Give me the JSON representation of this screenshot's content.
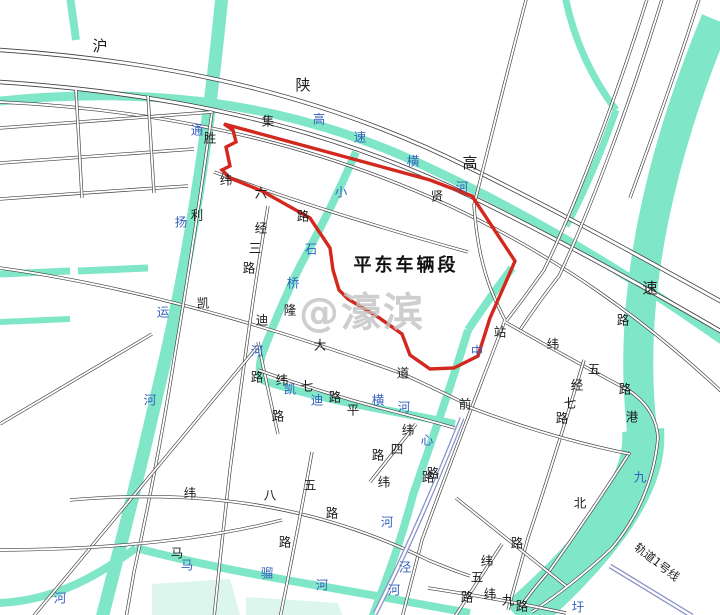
{
  "title": {
    "site_label": "平东车辆段"
  },
  "legend": {
    "rail_line_label": "轨道1号线"
  },
  "watermark": {
    "text": "@濠滨"
  },
  "palette": {
    "river": "#7fe7c8",
    "pond": "#dcf6ee",
    "road_casing": "#3f3f3f",
    "road_fill": "#ffffff",
    "boundary_red": "#d2281e",
    "label_black": "#1c1c1c",
    "label_blue": "#3560c0",
    "metro": "#8a92c8",
    "watermark_gray": "#c2c2c2"
  },
  "map": {
    "width": 720,
    "height": 615,
    "ponds": [
      {
        "id": "pond-west",
        "points": "152,584 230,579 240,615 152,615"
      },
      {
        "id": "pond-east",
        "points": "246,597 338,603 342,615 246,615"
      }
    ],
    "rivers": [
      {
        "id": "tongyang-canal",
        "w": 13,
        "d": "M222,-5 C210,120 192,250 158,390 C140,470 122,540 102,618"
      },
      {
        "id": "nw-stub",
        "w": 8,
        "d": "M70,-4 L76,40"
      },
      {
        "id": "strip-a",
        "w": 7,
        "d": "M0,274 L70,271"
      },
      {
        "id": "strip-b",
        "w": 7,
        "d": "M78,271 L148,268"
      },
      {
        "id": "strip-c",
        "w": 6,
        "d": "M0,322 L70,319"
      },
      {
        "id": "gaosu-henghe",
        "w": 9,
        "d": "M0,101 C150,86 290,102 425,166 C520,210 620,268 722,340"
      },
      {
        "id": "ne-stream-a",
        "w": 7,
        "d": "M565,-4 Q578,60 616,110"
      },
      {
        "id": "ne-stream-b",
        "w": 7,
        "d": "M616,110 Q592,178 566,226"
      },
      {
        "id": "jiuyu-port",
        "w": 30,
        "d": "M716,20 C662,150 628,290 641,420 C648,480 600,545 518,618"
      },
      {
        "id": "jiuyu-port-wide",
        "w": 42,
        "d": "M643,430 C648,482 602,546 520,618"
      },
      {
        "id": "xiaoshiqiao-river",
        "w": 8,
        "d": "M356,152 Q330,212 300,266 Q278,312 263,352 Q257,368 262,380"
      },
      {
        "id": "kaidi-henghe",
        "w": 8,
        "d": "M262,380 C320,400 390,410 455,424"
      },
      {
        "id": "zhongxin-river-a",
        "w": 8,
        "d": "M512,268 Q488,300 468,330"
      },
      {
        "id": "zhongxin-river-b",
        "w": 8,
        "d": "M468,330 C450,390 430,445 413,495 C400,545 386,580 372,618"
      },
      {
        "id": "maliu-river-a",
        "w": 8,
        "d": "M0,603 C58,600 100,574 136,548"
      },
      {
        "id": "maliu-river-b",
        "w": 8,
        "d": "M136,548 C220,570 300,582 382,597 Q430,606 470,613"
      }
    ],
    "roads": [
      {
        "id": "expressway-n",
        "major": true,
        "d": "M0,50 C180,62 330,98 470,168 C560,212 650,262 722,302"
      },
      {
        "id": "expressway-s",
        "major": true,
        "d": "M0,82 C180,94 330,128 470,196 C560,240 650,290 722,332"
      },
      {
        "id": "jixian-road",
        "d": "M0,102 C170,110 320,146 450,206 C560,258 645,320 722,392"
      },
      {
        "id": "ne-diagonal-a",
        "d": "M527,-4 C505,80 488,150 474,205 C478,265 492,295 505,320"
      },
      {
        "id": "ne-diagonal-b",
        "d": "M648,-4 C616,98 578,200 544,270 Q524,298 507,320"
      },
      {
        "id": "ne-diagonal-b2",
        "d": "M663,-4 C631,100 593,204 559,276 Q540,300 520,330"
      },
      {
        "id": "ne-diagonal-c",
        "d": "M700,-4 C678,66 654,132 630,198"
      },
      {
        "id": "zhanqian-road",
        "d": "M505,320 C478,392 448,468 422,540 L402,618"
      },
      {
        "id": "wei5-road",
        "d": "M505,322 Q572,360 628,390 Q656,408 658,438"
      },
      {
        "id": "bank-road",
        "d": "M658,438 Q652,500 612,548 Q574,584 532,612"
      },
      {
        "id": "jing7-road",
        "d": "M584,360 C566,420 548,478 528,538 L508,610"
      },
      {
        "id": "north-road",
        "d": "M630,452 Q590,514 550,570 Q532,590 520,608"
      },
      {
        "id": "cross-road",
        "d": "M466,406 Q550,438 630,454"
      },
      {
        "id": "kaidi-avenue",
        "d": "M0,268 C130,286 270,326 403,374 Q442,392 466,404"
      },
      {
        "id": "shengli-road",
        "d": "M212,112 Q196,230 174,360 Q158,462 134,572 L126,618"
      },
      {
        "id": "wei6-road",
        "d": "M214,172 Q330,214 468,252"
      },
      {
        "id": "jing3-road",
        "d": "M268,206 C252,300 242,380 230,470 Q222,540 214,618"
      },
      {
        "id": "vert-road-16",
        "d": "M258,342 Q268,390 278,434"
      },
      {
        "id": "sw-long-diagonal",
        "d": "M32,618 L258,346"
      },
      {
        "id": "west-join",
        "d": "M0,424 L152,334"
      },
      {
        "id": "wei7-road",
        "d": "M258,370 Q320,392 380,408 Q420,418 455,428"
      },
      {
        "id": "wei8-road",
        "d": "M70,500 C220,487 330,512 428,560 Q452,570 470,576"
      },
      {
        "id": "sw-ew-road",
        "d": "M0,550 Q170,549 282,520"
      },
      {
        "id": "vert-road-22",
        "d": "M312,452 Q296,540 280,618"
      },
      {
        "id": "wei9-road",
        "d": "M428,588 Q500,599 566,613"
      },
      {
        "id": "jing8-road",
        "d": "M502,544 L454,618"
      },
      {
        "id": "se-link-road",
        "d": "M456,498 L566,586"
      },
      {
        "id": "wei4-road",
        "d": "M416,424 L370,482"
      },
      {
        "id": "nw-grid-h1",
        "d": "M0,128 Q110,120 212,112"
      },
      {
        "id": "nw-grid-h2",
        "d": "M0,163 Q100,156 194,149"
      },
      {
        "id": "nw-grid-h3",
        "d": "M0,199 Q95,192 188,186"
      },
      {
        "id": "nw-grid-v1",
        "d": "M76,90 L82,198"
      },
      {
        "id": "nw-grid-v2",
        "d": "M148,96 L154,193"
      }
    ],
    "metro": [
      {
        "id": "rail-line1-west",
        "d": "M462,418 C438,478 410,545 375,614"
      },
      {
        "id": "rail-line1-east",
        "d": "M610,566 L692,616"
      }
    ],
    "boundary": {
      "id": "pingdong-depot-boundary",
      "d": "M224,124 L320,150 L430,180 L472,196 L515,261 L505,284 L490,318 L478,356 L454,368 L430,369 L410,355 L402,334 L378,317 L348,299 L339,290 L333,270 L330,248 L310,218 L262,191 L230,178 L222,170 L230,166 L226,147 L236,142 L233,130 Z"
    },
    "label_groups": [
      {
        "id": "river-tongyang-canal",
        "color": "blue",
        "chars": [
          [
            "通",
            197,
            130
          ],
          [
            "扬",
            181,
            222
          ],
          [
            "运",
            163,
            312
          ],
          [
            "河",
            150,
            400
          ]
        ]
      },
      {
        "id": "river-west-he",
        "color": "blue",
        "chars": [
          [
            "河",
            60,
            598
          ]
        ]
      },
      {
        "id": "river-gaosu-henghe",
        "color": "blue",
        "chars": [
          [
            "高",
            319,
            119
          ],
          [
            "速",
            360,
            137
          ],
          [
            "横",
            413,
            161
          ],
          [
            "河",
            462,
            187
          ]
        ]
      },
      {
        "id": "river-xiaoshiqiao",
        "color": "blue",
        "chars": [
          [
            "小",
            341,
            192
          ],
          [
            "石",
            311,
            249
          ],
          [
            "桥",
            293,
            283
          ],
          [
            "河",
            257,
            351
          ]
        ]
      },
      {
        "id": "river-kaidi-henghe",
        "color": "blue",
        "chars": [
          [
            "凯",
            290,
            389
          ],
          [
            "迪",
            317,
            400
          ],
          [
            "横",
            378,
            400
          ],
          [
            "河",
            404,
            407
          ]
        ]
      },
      {
        "id": "river-zhongxin",
        "color": "blue",
        "chars": [
          [
            "中",
            477,
            351
          ],
          [
            "心",
            427,
            440
          ],
          [
            "河",
            387,
            522
          ]
        ]
      },
      {
        "id": "river-jing",
        "color": "blue",
        "chars": [
          [
            "泾",
            405,
            567
          ],
          [
            "河",
            394,
            590
          ]
        ]
      },
      {
        "id": "river-maliu",
        "color": "blue",
        "chars": [
          [
            "马",
            187,
            565
          ],
          [
            "骝",
            267,
            573
          ],
          [
            "河",
            322,
            585
          ]
        ]
      },
      {
        "id": "river-jiuyu-port",
        "color": "blue",
        "chars": [
          [
            "九",
            640,
            477
          ],
          [
            "圩",
            578,
            607
          ]
        ]
      },
      {
        "id": "expressway-hushaan",
        "color": "black",
        "size": 15,
        "chars": [
          [
            "沪",
            100,
            46
          ],
          [
            "陕",
            303,
            85
          ],
          [
            "高",
            470,
            163
          ],
          [
            "速",
            650,
            288
          ]
        ]
      },
      {
        "id": "road-jixian",
        "color": "black",
        "chars": [
          [
            "集",
            268,
            121
          ],
          [
            "贤",
            437,
            196
          ],
          [
            "路",
            623,
            320
          ]
        ]
      },
      {
        "id": "road-shengli",
        "color": "black",
        "chars": [
          [
            "胜",
            210,
            138
          ],
          [
            "利",
            197,
            215
          ]
        ]
      },
      {
        "id": "road-wei6",
        "color": "black",
        "chars": [
          [
            "纬",
            226,
            180
          ],
          [
            "六",
            261,
            193
          ],
          [
            "路",
            303,
            216
          ]
        ]
      },
      {
        "id": "road-jing3",
        "color": "black",
        "chars": [
          [
            "经",
            261,
            228
          ],
          [
            "三",
            255,
            248
          ],
          [
            "路",
            249,
            268
          ]
        ]
      },
      {
        "id": "road-lu-pair",
        "color": "black",
        "chars": [
          [
            "路",
            257,
            377
          ],
          [
            "路",
            278,
            416
          ]
        ]
      },
      {
        "id": "road-kaidi-avenue",
        "color": "black",
        "chars": [
          [
            "凯",
            203,
            303
          ],
          [
            "迪",
            262,
            320
          ],
          [
            "大",
            320,
            345
          ],
          [
            "道",
            403,
            373
          ]
        ]
      },
      {
        "id": "char-long",
        "color": "black",
        "chars": [
          [
            "隆",
            290,
            310
          ]
        ]
      },
      {
        "id": "road-wei7",
        "color": "black",
        "chars": [
          [
            "纬",
            282,
            380
          ],
          [
            "七",
            307,
            386
          ],
          [
            "路",
            335,
            397
          ]
        ]
      },
      {
        "id": "char-ping",
        "color": "black",
        "chars": [
          [
            "平",
            353,
            410
          ]
        ]
      },
      {
        "id": "road-wei4",
        "color": "black",
        "chars": [
          [
            "纬",
            408,
            430
          ],
          [
            "四",
            397,
            449
          ],
          [
            "路",
            378,
            455
          ]
        ]
      },
      {
        "id": "road-wei-lu",
        "color": "black",
        "chars": [
          [
            "纬",
            384,
            482
          ],
          [
            "路",
            428,
            477
          ]
        ]
      },
      {
        "id": "road-zhanqian",
        "color": "black",
        "chars": [
          [
            "站",
            500,
            332
          ],
          [
            "前",
            465,
            404
          ],
          [
            "路",
            433,
            473
          ]
        ]
      },
      {
        "id": "road-wei5",
        "color": "black",
        "chars": [
          [
            "纬",
            553,
            344
          ],
          [
            "五",
            594,
            369
          ],
          [
            "路",
            625,
            389
          ]
        ]
      },
      {
        "id": "char-gang",
        "color": "black",
        "chars": [
          [
            "港",
            632,
            417
          ]
        ]
      },
      {
        "id": "road-jing7",
        "color": "black",
        "chars": [
          [
            "经",
            577,
            385
          ],
          [
            "七",
            570,
            403
          ],
          [
            "路",
            562,
            418
          ]
        ]
      },
      {
        "id": "char-bei",
        "color": "black",
        "chars": [
          [
            "北",
            580,
            503
          ]
        ]
      },
      {
        "id": "char-lu-se",
        "color": "black",
        "chars": [
          [
            "路",
            517,
            543
          ]
        ]
      },
      {
        "id": "char-ma",
        "color": "black",
        "chars": [
          [
            "马",
            177,
            553
          ]
        ]
      },
      {
        "id": "road-wei8",
        "color": "black",
        "chars": [
          [
            "纬",
            190,
            493
          ],
          [
            "八",
            270,
            495
          ],
          [
            "路",
            332,
            513
          ],
          [
            "路",
            285,
            542
          ]
        ]
      },
      {
        "id": "char-wu",
        "color": "black",
        "chars": [
          [
            "五",
            310,
            485
          ]
        ]
      },
      {
        "id": "road-wei5-s",
        "color": "black",
        "chars": [
          [
            "纬",
            487,
            561
          ],
          [
            "五",
            477,
            577
          ],
          [
            "路",
            467,
            597
          ]
        ]
      },
      {
        "id": "road-wei9",
        "color": "black",
        "chars": [
          [
            "纬",
            490,
            594
          ],
          [
            "九",
            508,
            600
          ],
          [
            "路",
            522,
            606
          ]
        ]
      }
    ]
  }
}
